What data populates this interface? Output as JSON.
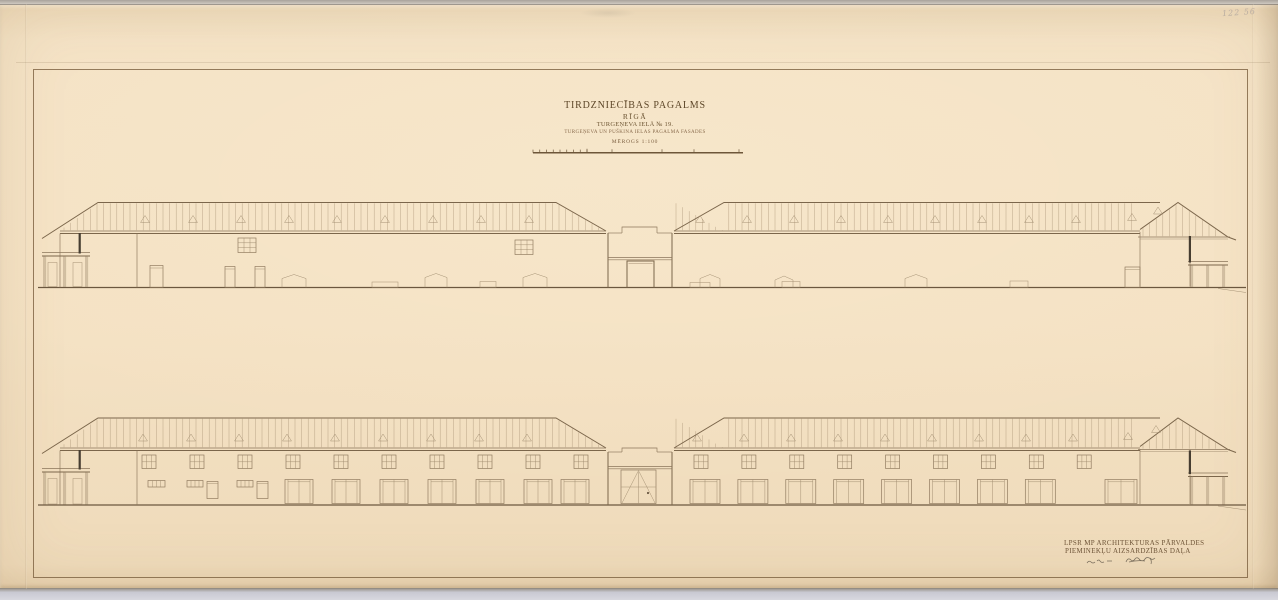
{
  "title_block": {
    "line1": "TIRDZNIECĪBAS PAGALMS",
    "line2": "RĪGĀ",
    "line3": "TURGEŅEVA IELĀ № 19.",
    "line4": "TURGEŅEVA UN PUŠKINA IELAS PAGALMA FASADES",
    "scale": "MĒROGS 1:100"
  },
  "stamp_block": {
    "line1": "LPSR MP ARCHITEKTURAS PĀRVALDES",
    "line2": "PIEMINEKĻU AIZSARDZĪBAS DAĻA"
  },
  "annotations": {
    "archive_mark": "122 56",
    "handwritten_date_note": "illegible-pencil-scribble",
    "signature": "illegible-ink-signature-scribble"
  },
  "colors": {
    "paper": "#f3dfc1",
    "ink": "#8a755a",
    "ink_dark": "#6b573f",
    "title_ink": "#5d4628",
    "accent_dark": "#463d31",
    "scan_background": "#c9c9d1"
  }
}
